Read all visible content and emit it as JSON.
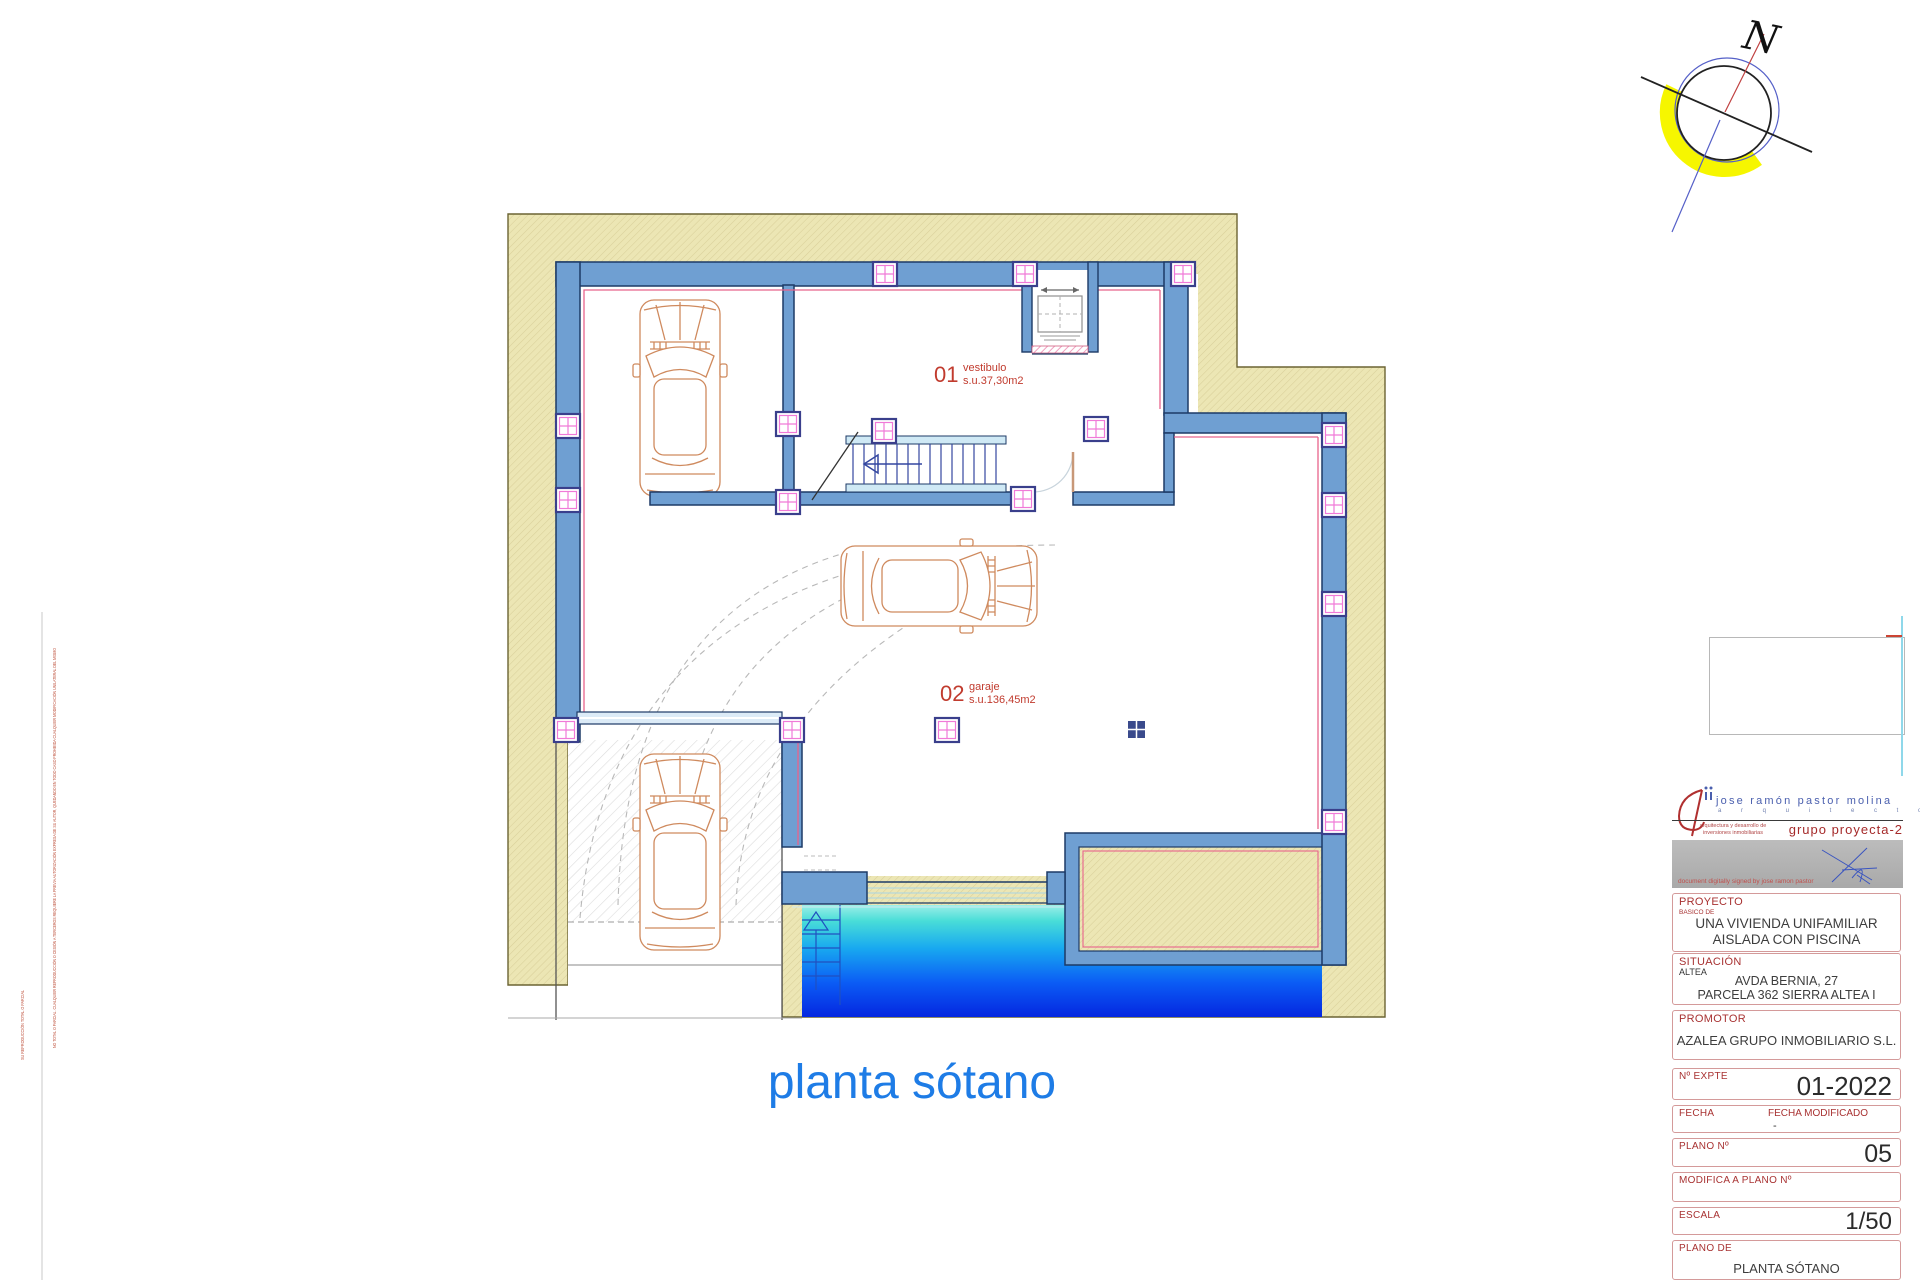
{
  "drawing_title": "planta sótano",
  "compass": {
    "letter": "N"
  },
  "rooms": [
    {
      "number": "01",
      "name": "vestibulo",
      "area": "s.u.37,30m2"
    },
    {
      "number": "02",
      "name": "garaje",
      "area": "s.u.136,45m2"
    }
  ],
  "margin_notes": {
    "line1": "NO TOTAL O PARCIAL. CUALQUIER REPRODUCCIÓN O CESIÓN A TERCEROS REQUIERE LA PREVIA AUTORIZACIÓN EXPRESA DE SU AUTOR, QUEDANDO EN TODO CASO PROHIBIDA CUALQUIER MODIFICACIÓN UNILATERAL DEL MISMO",
    "line2": "SU REPRODUCCIÓN TOTAL O PARCIAL"
  },
  "title_block": {
    "architect_name": "jose ramón pastor molina",
    "architect_title": "a r q u i t e c t o",
    "studio_line1": "arquitectura y desarrollo de",
    "studio_line2": "inversiones inmobiliarias",
    "group_name": "grupo proyecta-2",
    "signature_note": "document  digitally  signed  by  jose ramon pastor",
    "proyecto": {
      "label": "PROYECTO",
      "sublabel": "BASICO DE",
      "line1": "UNA VIVIENDA UNIFAMILIAR",
      "line2": "AISLADA CON PISCINA"
    },
    "situacion": {
      "label": "SITUACIÓN",
      "place": "ALTEA",
      "line1": "AVDA  BERNIA, 27",
      "line2": "PARCELA 362 SIERRA ALTEA I"
    },
    "promotor": {
      "label": "PROMOTOR",
      "value": "AZALEA GRUPO INMOBILIARIO S.L."
    },
    "expediente": {
      "label": "Nº EXPTE",
      "value": "01-2022"
    },
    "fecha": {
      "label": "FECHA",
      "label_mod": "FECHA MODIFICADO",
      "value_mod": "-"
    },
    "plano_num": {
      "label": "PLANO Nº",
      "value": "05"
    },
    "modifica": {
      "label": "MODIFICA A PLANO Nº"
    },
    "escala": {
      "label": "ESCALA",
      "value": "1/50"
    },
    "plano_de": {
      "label": "PLANO DE",
      "value": "PLANTA SÓTANO"
    }
  },
  "colors": {
    "wall_blue": "#6f9fd2",
    "outline_navy": "#1d3a66",
    "excavation_tan": "#ece6b4",
    "accent_pink": "#e8638c",
    "pool_deep_blue": "#0527e0",
    "title_blue": "#1e7ce6",
    "label_red": "#c13b2e",
    "compass_yellow": "#f6f600"
  }
}
